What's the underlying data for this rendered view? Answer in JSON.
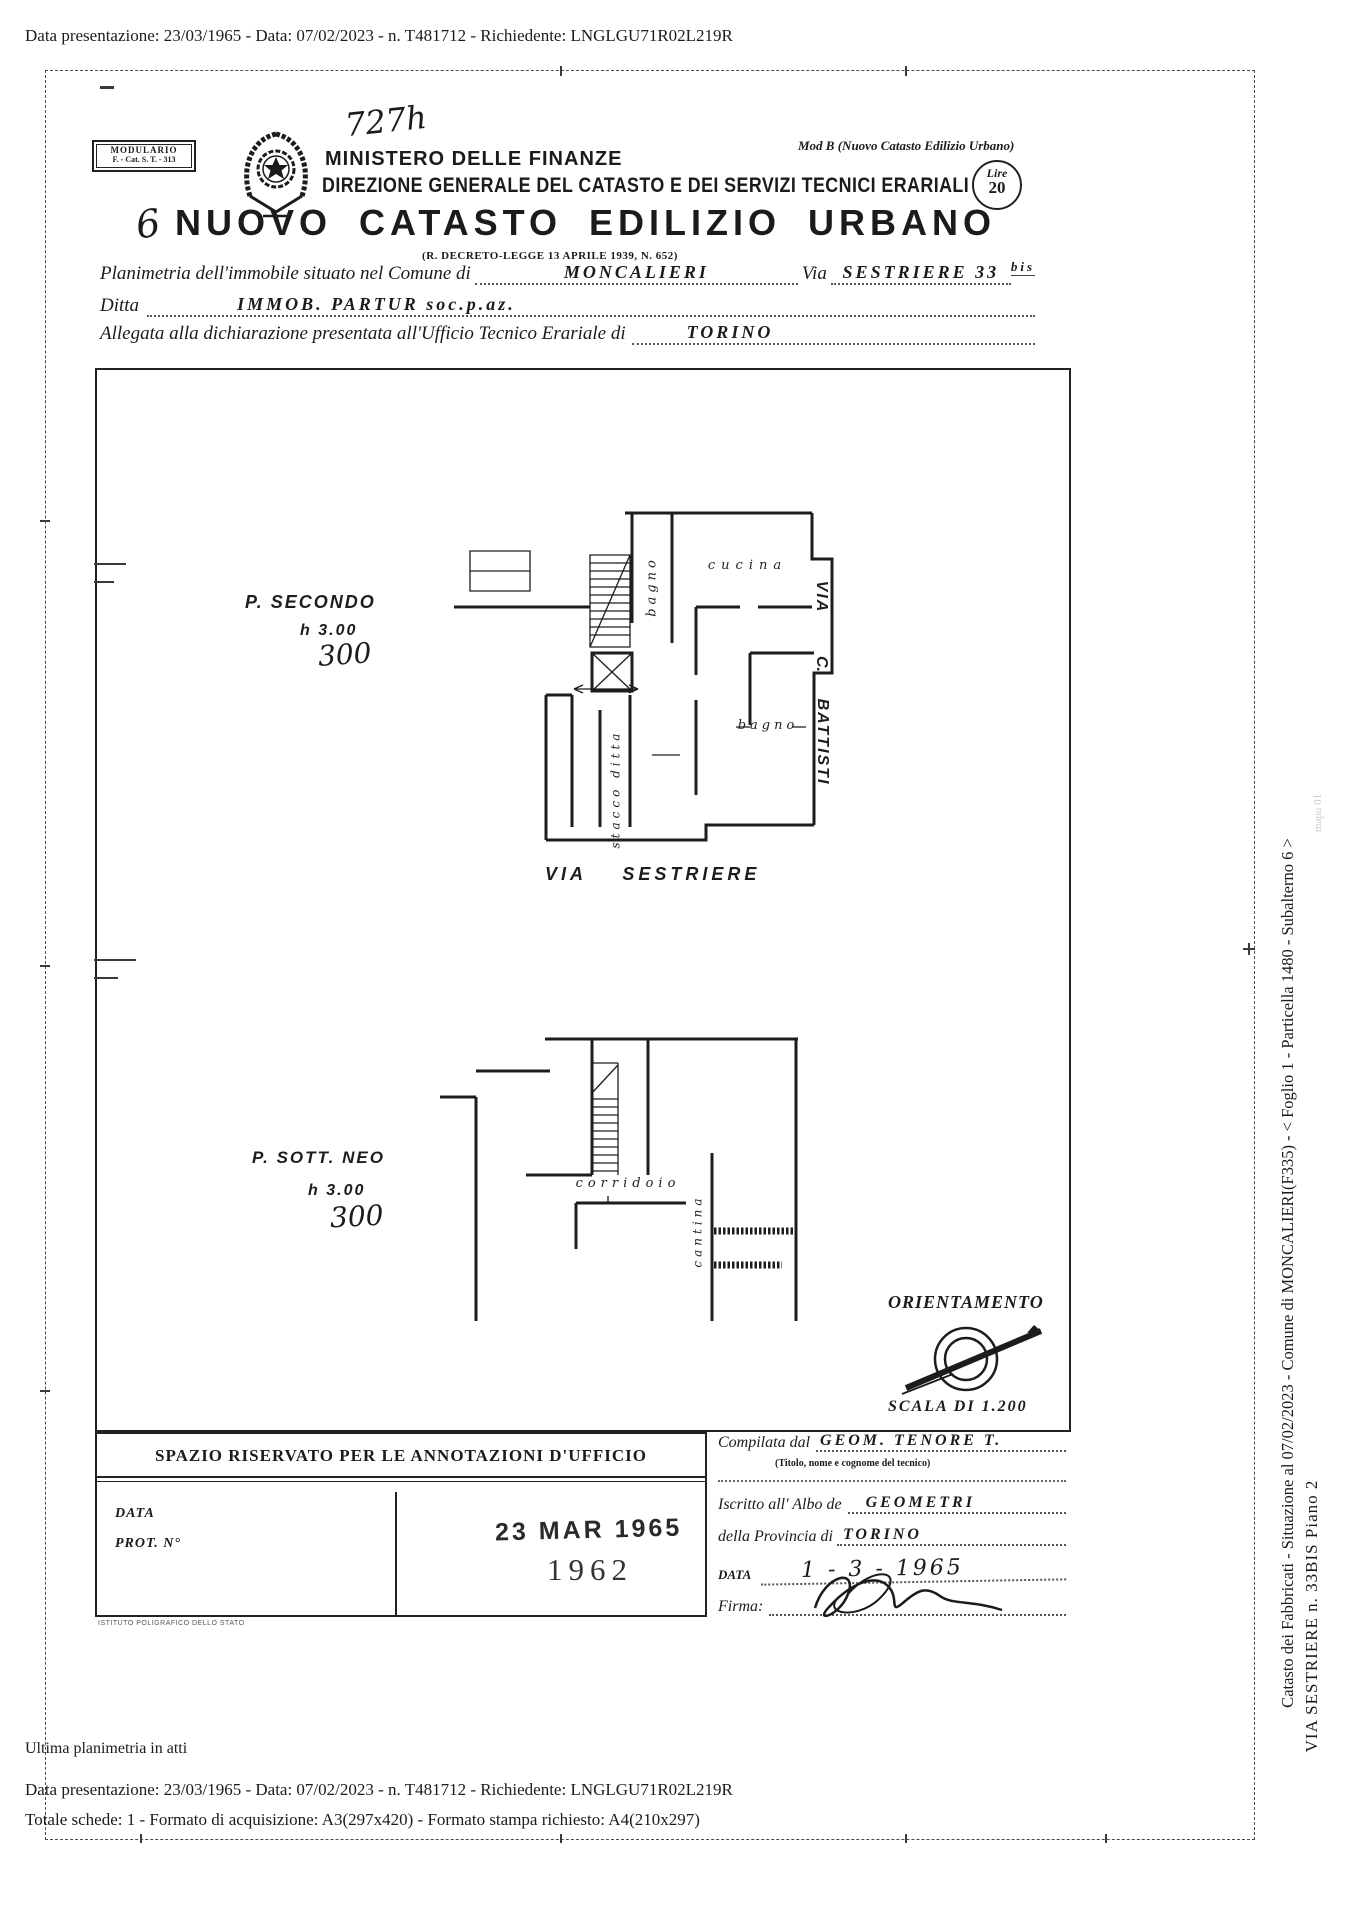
{
  "page": {
    "top_line": "Data presentazione: 23/03/1965 - Data: 07/02/2023 - n. T481712 - Richiedente: LNGLGU71R02L219R"
  },
  "header": {
    "modulario_line1": "MODULARIO",
    "modulario_line2": "F. - Cat. S. T. - 313",
    "handwritten_number": "727h",
    "ministry": "MINISTERO DELLE FINANZE",
    "direzione": "DIREZIONE GENERALE DEL CATASTO E DEI SERVIZI TECNICI ERARIALI",
    "mod_b": "Mod B (Nuovo Catasto Edilizio Urbano)",
    "lire_label": "Lire",
    "lire_value": "20",
    "handwritten_6": "6",
    "title": "NUOVO CATASTO EDILIZIO URBANO",
    "subtitle": "(R. DECRETO-LEGGE 13 APRILE 1939, N. 652)"
  },
  "form": {
    "line1_label": "Planimetria dell'immobile situato nel Comune di",
    "line1_value": "MONCALIERI",
    "line1_label2": "Via",
    "line1_value2": "SESTRIERE  33",
    "line1_sup": "bis",
    "line2_label": "Ditta",
    "line2_value": "IMMOB.   PARTUR   soc.p.az.",
    "line3_label": "Allegata alla dichiarazione presentata all'Ufficio Tecnico Erariale di",
    "line3_value": "TORINO"
  },
  "plan": {
    "floor1_label": "P. SECONDO",
    "floor1_height": "h  3.00",
    "floor1_handwritten": "300",
    "floor2_label": "P. SOTT. NEO",
    "floor2_height": "h  3.00",
    "floor2_handwritten": "300",
    "room_bagno1": "bagno",
    "room_cucina": "cucina",
    "room_bagno2": "bagno",
    "room_corridoio": "corridoio",
    "room_cantina": "cantina",
    "stacco_ditta": "stacco ditta",
    "street_right_1": "VIA",
    "street_right_2": "C.",
    "street_right_3": "BATTISTI",
    "street_bottom": "VIA    SESTRIERE",
    "orientamento": "ORIENTAMENTO",
    "scala": "SCALA DI 1.200"
  },
  "annotations": {
    "box_title": "SPAZIO RISERVATO PER LE ANNOTAZIONI D'UFFICIO",
    "data_label": "DATA",
    "prot_label": "PROT. N°",
    "stamp_date": "23 MAR 1965",
    "stamp_year": "1962",
    "printer": "ISTITUTO POLIGRAFICO DELLO STATO",
    "compilata_label": "Compilata dal",
    "compilata_value": "GEOM.  TENORE  T.",
    "compilata_sub": "(Titolo, nome e cognome del tecnico)",
    "albo_label": "Iscritto all' Albo de",
    "albo_value": "GEOMETRI",
    "provincia_label": "della Provincia di",
    "provincia_value": "TORINO",
    "data_label2": "DATA",
    "data_value": "1 - 3 - 1965",
    "firma_label": "Firma:"
  },
  "sidebar": {
    "line1": "Catasto dei Fabbricati - Situazione al 07/02/2023 - Comune di MONCALIERI(F335) - < Foglio 1 - Particella  1480 - Subalterno 6 >",
    "line2": "VIA SESTRIERE n. 33BIS Piano 2",
    "faint": "mapu 01"
  },
  "footer": {
    "line1": "Ultima planimetria in atti",
    "line2": "Data presentazione: 23/03/1965 - Data: 07/02/2023 - n. T481712 - Richiedente: LNGLGU71R02L219R",
    "line3": "Totale schede: 1 - Formato di acquisizione: A3(297x420)  - Formato stampa richiesto: A4(210x297)"
  }
}
